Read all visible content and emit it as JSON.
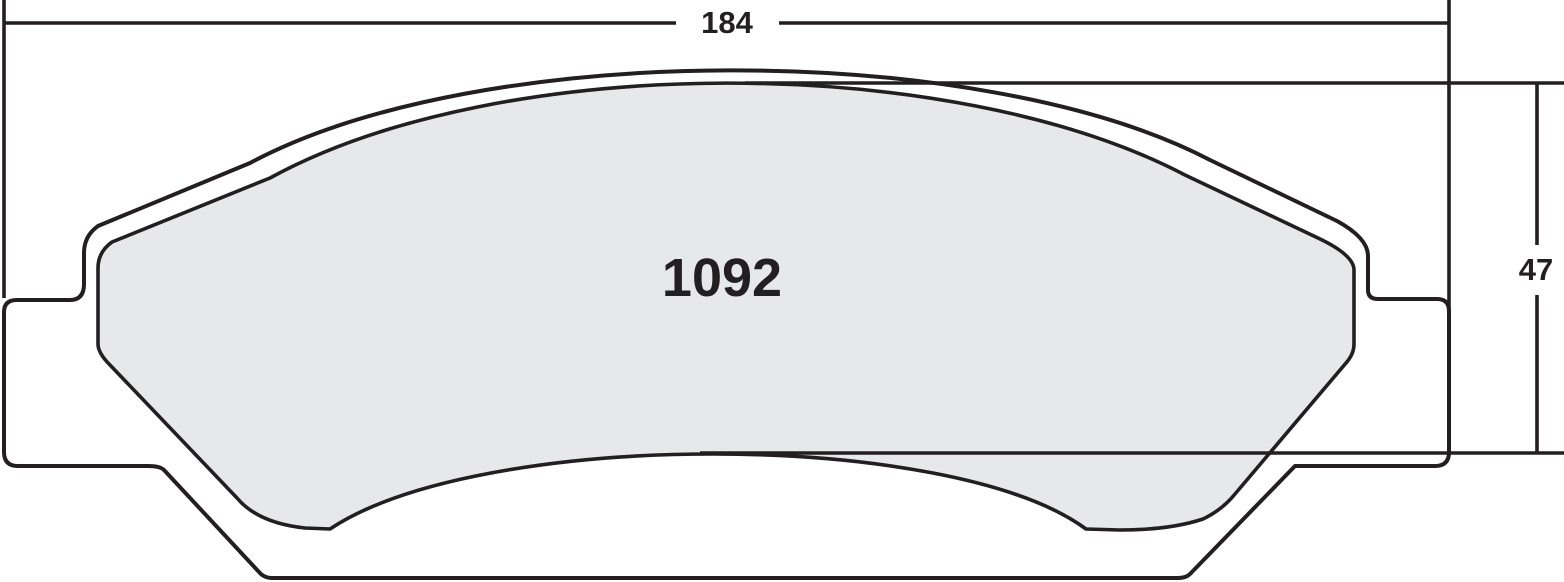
{
  "drawing": {
    "part_number": "1092",
    "width_dim_label": "184",
    "height_dim_label": "47"
  },
  "colors": {
    "line": "#231f20",
    "friction_fill": "#e7e8e9",
    "plate_fill": "#ffffff",
    "background": "#ffffff"
  }
}
